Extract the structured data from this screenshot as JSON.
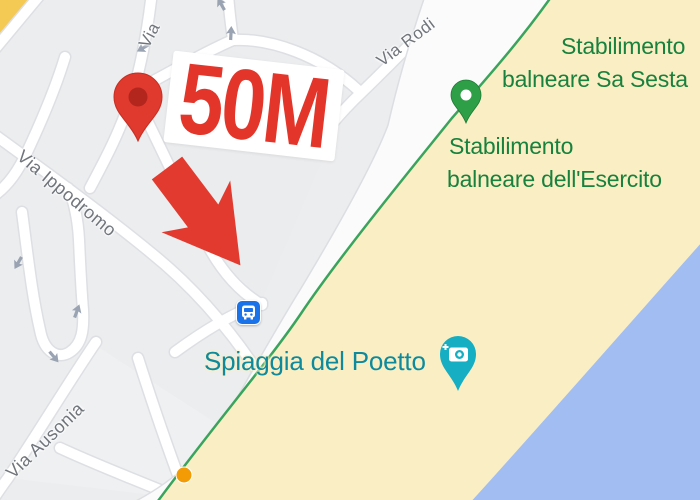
{
  "map": {
    "street_labels": {
      "partial_top": "Via",
      "via_rodi": "Via Rodi",
      "via_ippodromo": "Via Ippodromo",
      "via_ausonia": "Via Ausonia"
    },
    "poi": {
      "sa_sesta_line1": "Stabilimento",
      "sa_sesta_line2": "balneare Sa Sesta",
      "esercito_line1": "Stabilimento",
      "esercito_line2": "balneare dell'Esercito",
      "beach_label": "Spiaggia del Poetto"
    },
    "annotation": {
      "distance_text": "50M"
    },
    "markers": {
      "destination": "red-location-pin",
      "beach_club": "green-beach-club-pin",
      "photo_spot": "teal-photo-pin",
      "bus_stop": "bus-stop-icon"
    },
    "colors": {
      "annotation_red": "#E3352A",
      "pin_red": "#E0392D",
      "pin_red_inner": "#B3261E",
      "green_marker": "#2E9E47",
      "green_label": "#18813D",
      "teal_label": "#0E8A9C",
      "teal_marker": "#16AEC3",
      "bus_blue": "#1A73E8",
      "beach_sand": "#FAEFC4",
      "water_blue": "#A2BDF2",
      "path_green": "#3AA45C",
      "city_gray": "#ECEDEF",
      "field_orange": "#F4CA55",
      "dot_orange": "#F29B04"
    }
  }
}
